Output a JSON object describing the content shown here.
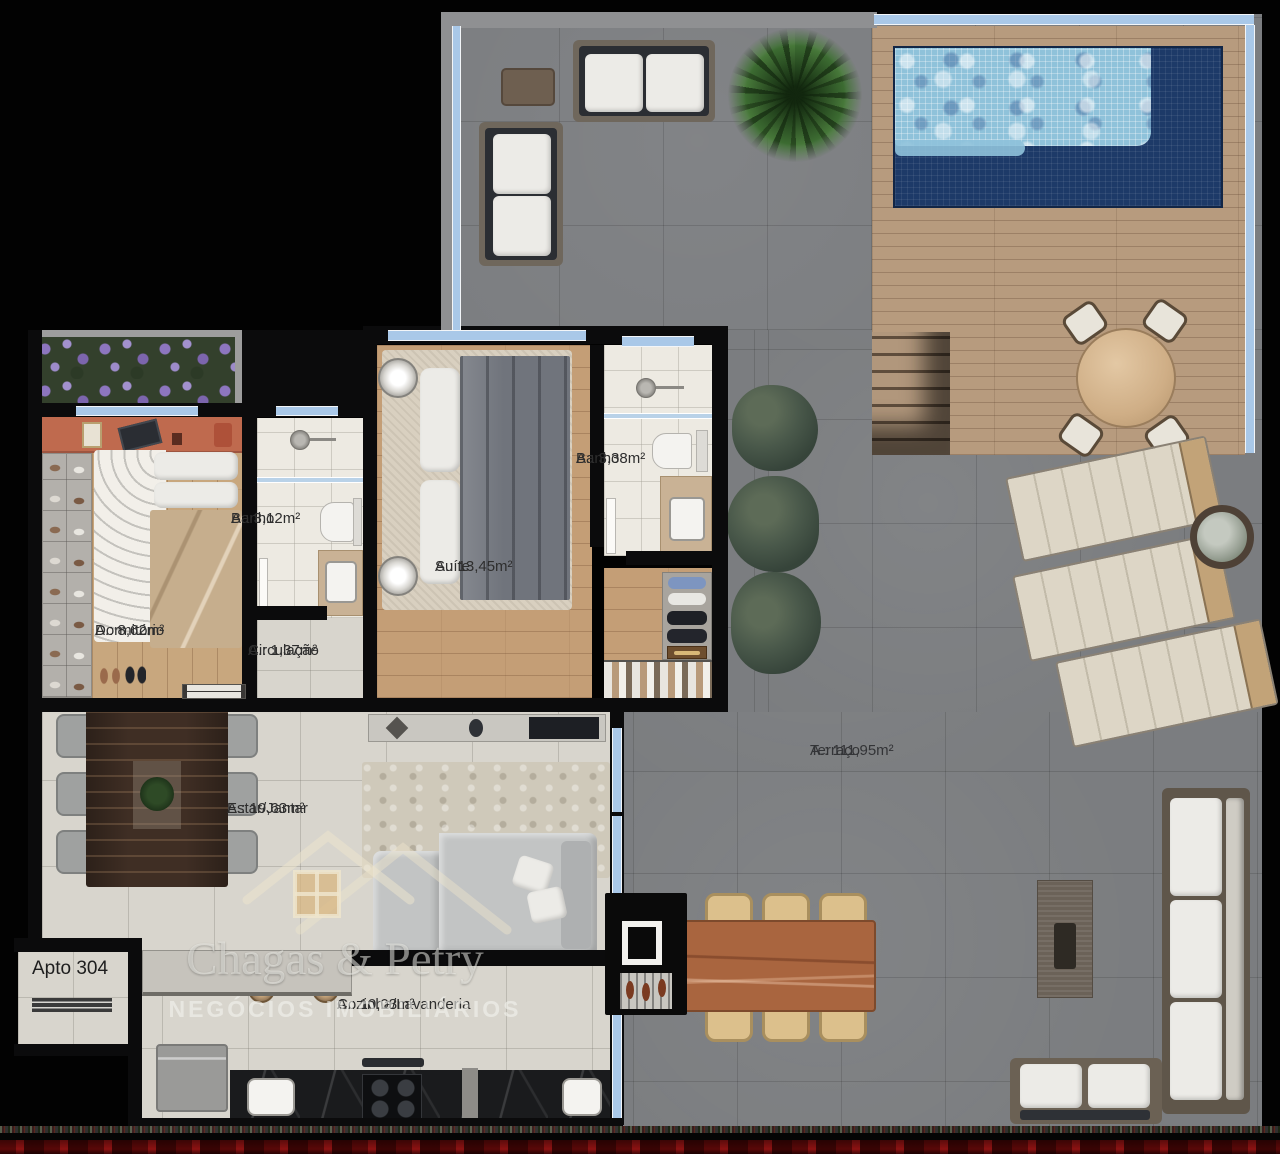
{
  "apartment": {
    "label": "Apto 304"
  },
  "rooms": [
    {
      "key": "dormitorio",
      "name": "Dormitório",
      "area": "A.: 8,62m²"
    },
    {
      "key": "banho-1",
      "name": "Banho",
      "area": "A.: 3,12m²"
    },
    {
      "key": "circulacao",
      "name": "Circulação",
      "area": "A.: 1,37m²"
    },
    {
      "key": "suite",
      "name": "Suíte",
      "area": "A.: 13,45m²"
    },
    {
      "key": "banho-2",
      "name": "Banho",
      "area": "A.: 3,38m²"
    },
    {
      "key": "estar-jantar",
      "name": "Estar/Jantar",
      "area": "A.: 19,63m²"
    },
    {
      "key": "terraco",
      "name": "Terraço",
      "area": "A.: 111,95m²"
    },
    {
      "key": "cozinha-lavanderia",
      "name": "Cozinha/Lavanderia",
      "area": "A.: 10,08m²"
    }
  ],
  "watermark": {
    "brand": "Chagas & Petry",
    "tagline": "NEGÓCIOS IMOBILIÁRIOS"
  },
  "colors": {
    "wall": "#0b0b0c",
    "window_glass": "#a9c8e8",
    "terrace_tile": "#7b7d80",
    "deck_wood": "#b79b7e",
    "pool_shallow": "#8fc2da",
    "pool_deep": "#1d3a68",
    "interior_tile": "#d8d5cd",
    "bath_tile": "#edeae2",
    "bedroom_wood": "#c8a77e",
    "accent_wall": "#bf6a4e",
    "bottom_band": "#8c1212"
  }
}
